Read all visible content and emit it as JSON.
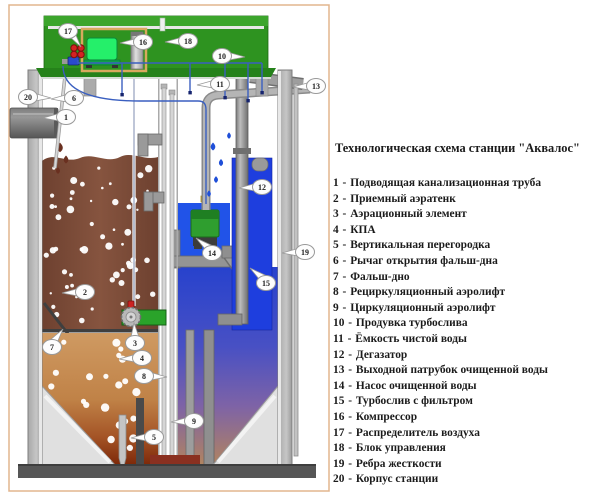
{
  "legend": {
    "title": "Технологическая схема станции \"Аквалос\"",
    "sep": " - ",
    "items": [
      {
        "num": "1",
        "label": "Подводящая канализационная труба"
      },
      {
        "num": "2",
        "label": "Приемный аэратенк"
      },
      {
        "num": "3",
        "label": "Аэрационный элемент"
      },
      {
        "num": "4",
        "label": "КПА"
      },
      {
        "num": "5",
        "label": "Вертикальная перегородка"
      },
      {
        "num": "6",
        "label": "Рычаг открытия фальш-дна"
      },
      {
        "num": "7",
        "label": "Фальш-дно"
      },
      {
        "num": "8",
        "label": "Рециркуляционный аэролифт"
      },
      {
        "num": "9",
        "label": "Циркуляционный аэролифт"
      },
      {
        "num": "10",
        "label": "Продувка турбослива"
      },
      {
        "num": "11",
        "label": "Ёмкость чистой воды"
      },
      {
        "num": "12",
        "label": "Дегазатор"
      },
      {
        "num": "13",
        "label": "Выходной патрубок очищенной воды"
      },
      {
        "num": "14",
        "label": "Насос очищенной воды"
      },
      {
        "num": "15",
        "label": "Турбослив с фильтром"
      },
      {
        "num": "16",
        "label": "Компрессор"
      },
      {
        "num": "17",
        "label": "Распределитель воздуха"
      },
      {
        "num": "18",
        "label": "Блок управления"
      },
      {
        "num": "19",
        "label": "Ребра жесткости"
      },
      {
        "num": "20",
        "label": "Корпус станции"
      }
    ]
  },
  "diagram": {
    "callouts": [
      {
        "n": "1"
      },
      {
        "n": "2"
      },
      {
        "n": "3"
      },
      {
        "n": "4"
      },
      {
        "n": "5"
      },
      {
        "n": "6"
      },
      {
        "n": "7"
      },
      {
        "n": "8"
      },
      {
        "n": "9"
      },
      {
        "n": "10"
      },
      {
        "n": "11"
      },
      {
        "n": "12"
      },
      {
        "n": "13"
      },
      {
        "n": "14"
      },
      {
        "n": "15"
      },
      {
        "n": "16"
      },
      {
        "n": "17"
      },
      {
        "n": "18"
      },
      {
        "n": "19"
      },
      {
        "n": "20"
      }
    ]
  },
  "colors": {
    "frame_tan": "#e2b58e",
    "lid_green": "#2e9320",
    "lid_top_green": "#3ca52c",
    "compressor_green": "#25ef6a",
    "sludge_brown": "#7b4a36",
    "clean_water_blue": "#1e3ede",
    "pump_green": "#2f9e2f",
    "distributor_red": "#d42222"
  }
}
